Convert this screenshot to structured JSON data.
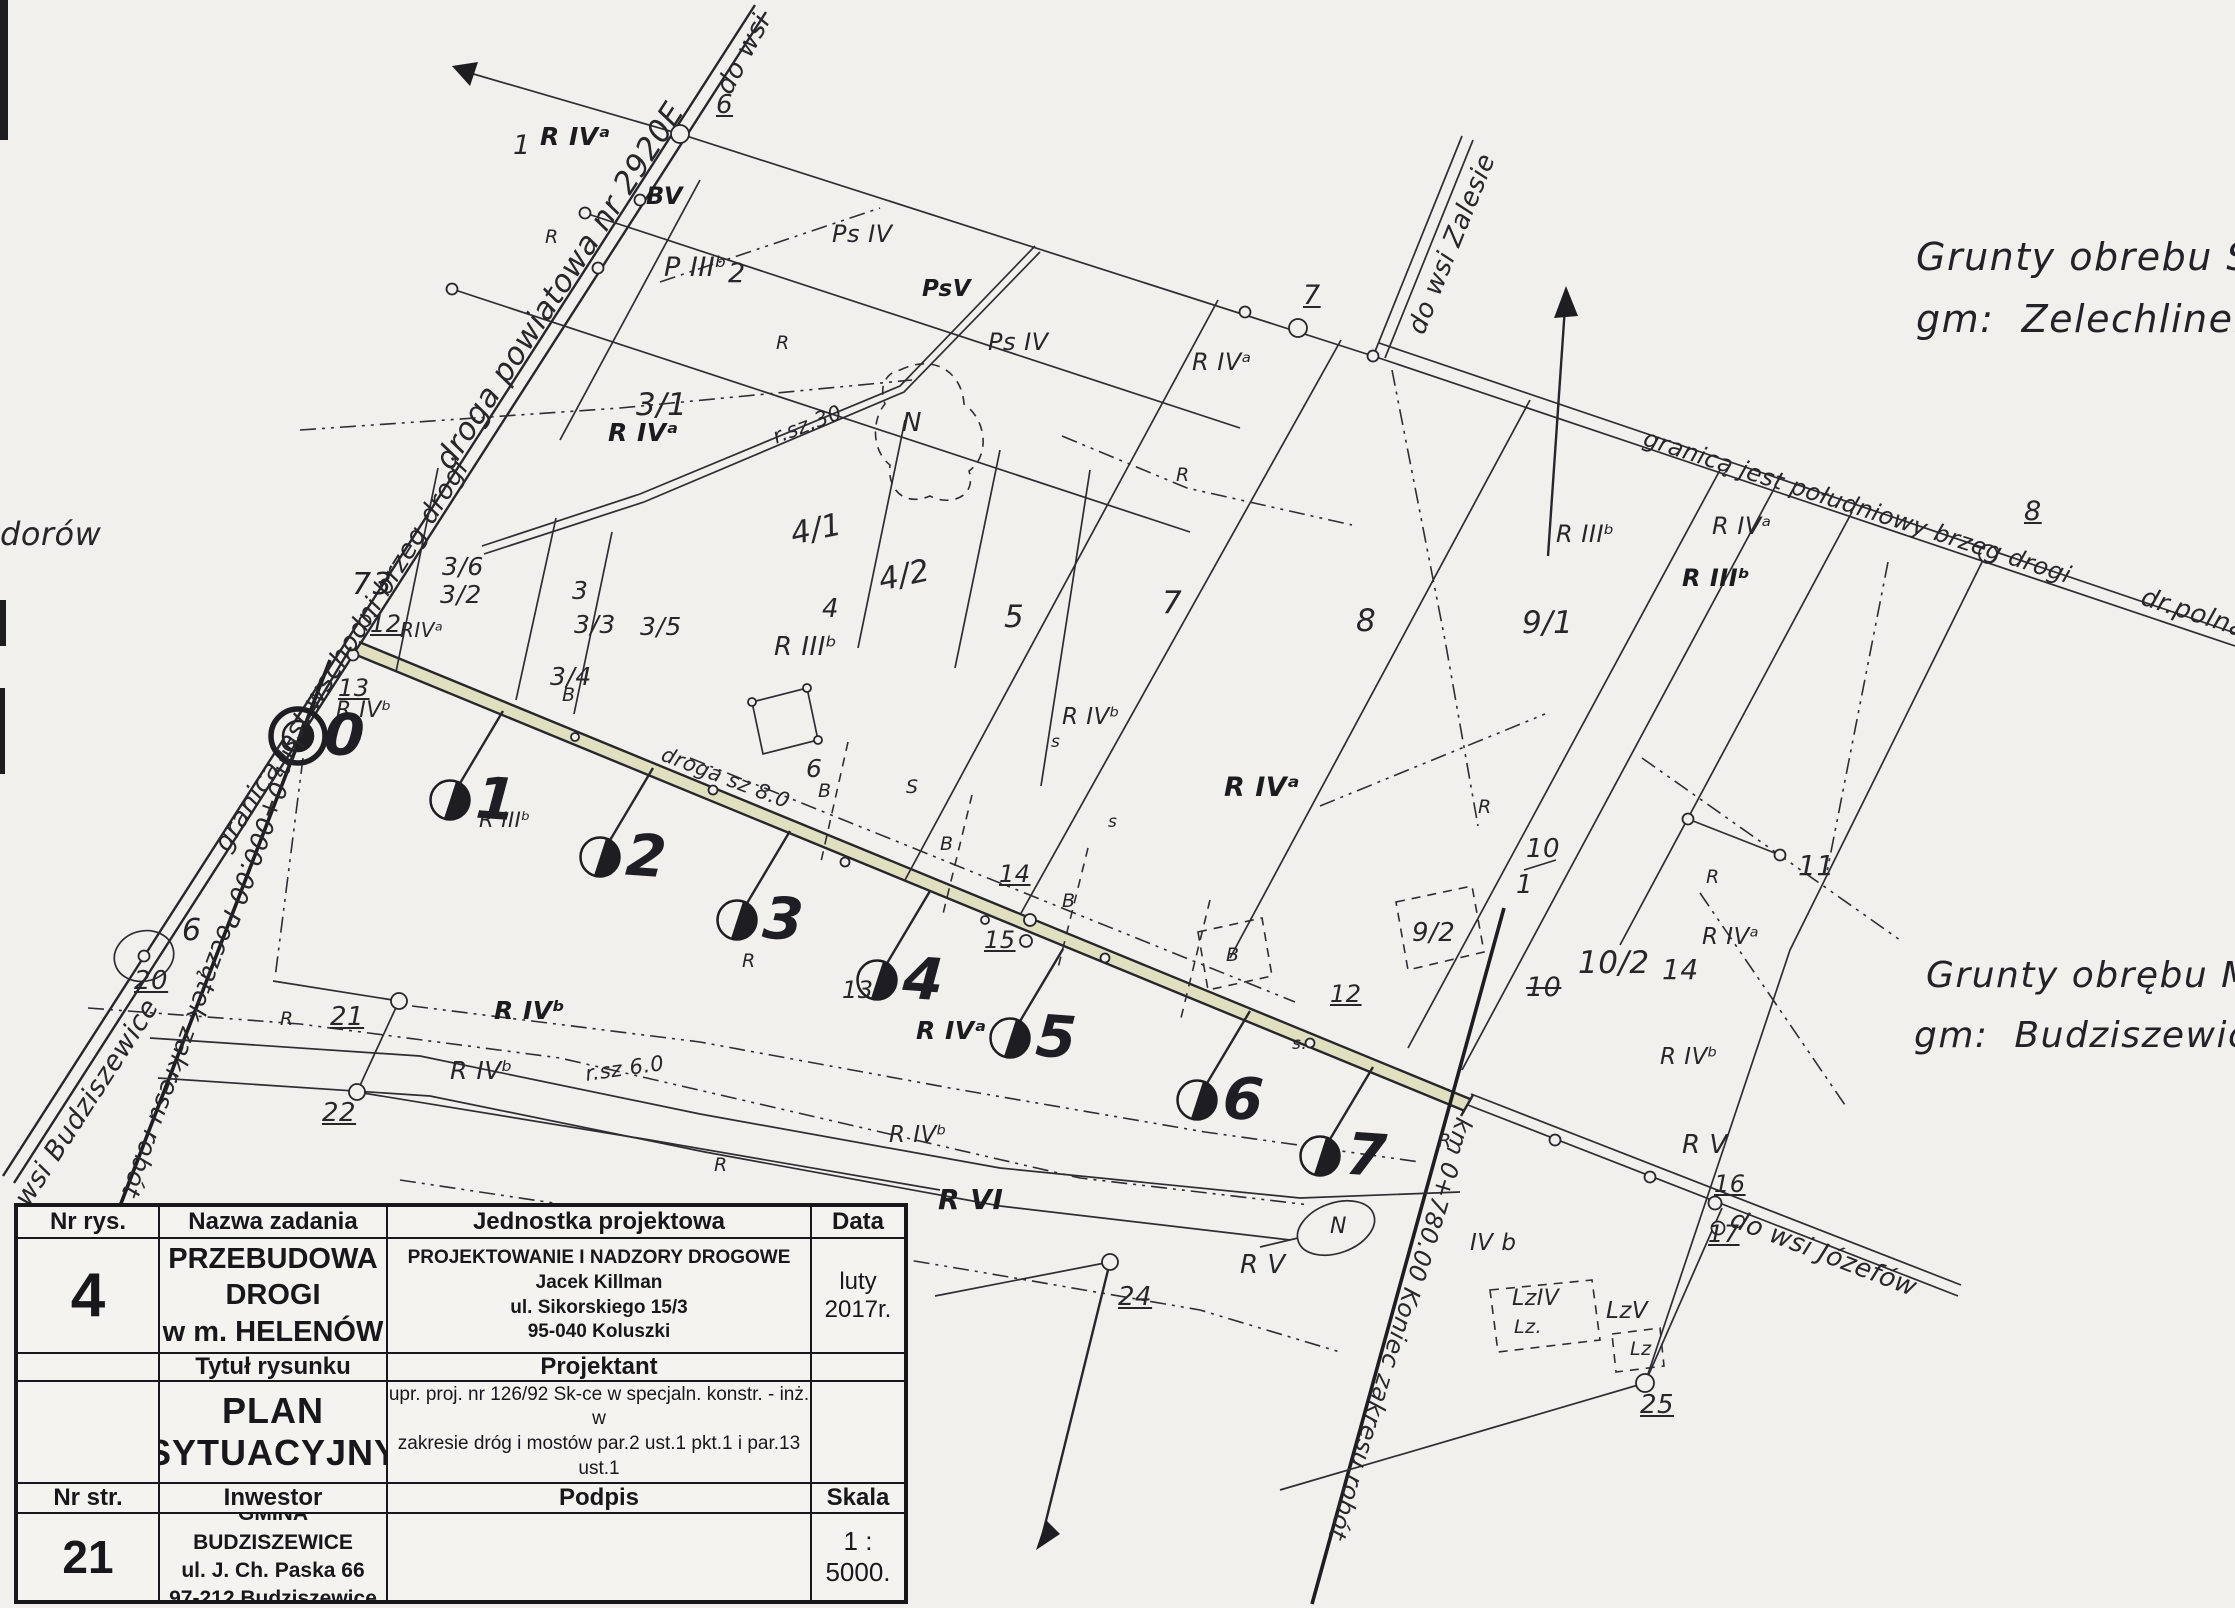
{
  "page": {
    "background": "#f1f0ec",
    "ink": "#26262b",
    "road_highlight": "#e0dfc0"
  },
  "title_block": {
    "headers": {
      "nr_rys": "Nr rys.",
      "nazwa_zadania": "Nazwa zadania",
      "jednostka": "Jednostka projektowa",
      "data": "Data",
      "tytul": "Tytuł rysunku",
      "projektant": "Projektant",
      "nr_str": "Nr str.",
      "inwestor": "Inwestor",
      "podpis": "Podpis",
      "skala": "Skala"
    },
    "values": {
      "drawing_number": "4",
      "task_name_line1": "PRZEBUDOWA DROGI",
      "task_name_line2": "w m. HELENÓW",
      "design_unit": [
        "PROJEKTOWANIE I NADZORY DROGOWE",
        "Jacek Killman",
        "ul. Sikorskiego 15/3",
        "95-040 Koluszki"
      ],
      "date": "luty 2017r.",
      "drawing_title": "PLAN SYTUACYJNY",
      "designer": [
        "mgr inż. Jacek Killman",
        "upr. proj. nr 126/92 Sk-ce w specjaln. konstr. - inż. w",
        "zakresie dróg i mostów par.2 ust.1 pkt.1 i par.13 ust.1",
        "pkt.3 lit.b"
      ],
      "page_number": "21",
      "investor": [
        "GMINA BUDZISZEWICE",
        "ul. J. Ch. Paska 66",
        "97-212 Budziszewice"
      ],
      "scale": "1 : 5000."
    }
  },
  "stations": [
    {
      "label": "0",
      "cx": 298,
      "cy": 736
    },
    {
      "label": "1",
      "cx": 450,
      "cy": 800
    },
    {
      "label": "2",
      "cx": 600,
      "cy": 857
    },
    {
      "label": "3",
      "cx": 737,
      "cy": 920
    },
    {
      "label": "4",
      "cx": 877,
      "cy": 980
    },
    {
      "label": "5",
      "cx": 1010,
      "cy": 1038
    },
    {
      "label": "6",
      "cx": 1197,
      "cy": 1100
    },
    {
      "label": "7",
      "cx": 1320,
      "cy": 1156
    }
  ],
  "map_labels": [
    {
      "t": "do wsi",
      "x": 712,
      "y": 86,
      "r": -62,
      "s": 26
    },
    {
      "t": "6",
      "x": 716,
      "y": 92,
      "s": 26,
      "c": "u"
    },
    {
      "t": "droga powiatowa nr 2920E",
      "x": 430,
      "y": 458,
      "r": -57,
      "s": 31
    },
    {
      "t": "granicą jest wschodni brzeg drogi",
      "x": 210,
      "y": 842,
      "r": -58,
      "s": 26
    },
    {
      "t": "km 0+000.00 Początek zakresu robót",
      "x": 308,
      "y": 742,
      "r": 110,
      "s": 25
    },
    {
      "t": "dorów",
      "x": 0,
      "y": 518,
      "s": 32
    },
    {
      "t": "wsi Budziszewice",
      "x": 10,
      "y": 1196,
      "r": -57,
      "s": 27
    },
    {
      "t": "granicą jest południowy brzeg drogi",
      "x": 1648,
      "y": 426,
      "r": 18,
      "s": 24
    },
    {
      "t": "dr.polna",
      "x": 2146,
      "y": 584,
      "r": 18,
      "s": 26
    },
    {
      "t": "do wsi Zalesie",
      "x": 1404,
      "y": 328,
      "r": -68,
      "s": 26
    },
    {
      "t": "do wsi Józefów",
      "x": 1736,
      "y": 1206,
      "r": 21,
      "s": 26
    },
    {
      "t": "km 0+780.00 Koniec zakresu robót",
      "x": 1476,
      "y": 1122,
      "r": 107,
      "s": 24
    },
    {
      "t": "droga sz 8.0",
      "x": 666,
      "y": 744,
      "r": 21,
      "s": 21
    },
    {
      "t": "r.sz.30",
      "x": 770,
      "y": 428,
      "r": -21,
      "s": 21
    },
    {
      "t": "r.sz 6.0",
      "x": 584,
      "y": 1064,
      "r": -8,
      "s": 21
    },
    {
      "t": "Grunty obrebu Świnio",
      "x": 1916,
      "y": 238,
      "s": 38,
      "c": "hand"
    },
    {
      "t": "gm:  Zelechlinek",
      "x": 1916,
      "y": 300,
      "s": 38,
      "c": "hand"
    },
    {
      "t": "Grunty obrębu Mie",
      "x": 1926,
      "y": 958,
      "s": 36,
      "c": "hand"
    },
    {
      "t": "gm:  Budziszewice",
      "x": 1914,
      "y": 1018,
      "s": 36,
      "c": "hand"
    },
    {
      "t": "7",
      "x": 1303,
      "y": 282,
      "s": 27,
      "c": "u"
    },
    {
      "t": "8",
      "x": 2024,
      "y": 498,
      "s": 27,
      "c": "u"
    },
    {
      "t": "12",
      "x": 370,
      "y": 612,
      "s": 24,
      "c": "u"
    },
    {
      "t": "13",
      "x": 338,
      "y": 676,
      "s": 24,
      "c": "u"
    },
    {
      "t": "73",
      "x": 352,
      "y": 570,
      "s": 30,
      "c": "hand"
    },
    {
      "t": "20",
      "x": 134,
      "y": 968,
      "s": 26,
      "c": "u"
    },
    {
      "t": "21",
      "x": 330,
      "y": 1004,
      "s": 26,
      "c": "u"
    },
    {
      "t": "22",
      "x": 322,
      "y": 1100,
      "s": 26,
      "c": "u"
    },
    {
      "t": "24",
      "x": 1118,
      "y": 1284,
      "s": 26,
      "c": "u"
    },
    {
      "t": "25",
      "x": 1640,
      "y": 1392,
      "s": 26,
      "c": "u"
    },
    {
      "t": "16",
      "x": 1714,
      "y": 1172,
      "s": 24,
      "c": "u"
    },
    {
      "t": "17",
      "x": 1708,
      "y": 1222,
      "s": 24,
      "c": "u"
    },
    {
      "t": "14",
      "x": 999,
      "y": 862,
      "s": 24,
      "c": "u"
    },
    {
      "t": "15",
      "x": 984,
      "y": 928,
      "s": 24,
      "c": "u"
    },
    {
      "t": "6",
      "x": 182,
      "y": 916,
      "s": 30,
      "c": "hand"
    },
    {
      "t": "1",
      "x": 513,
      "y": 132,
      "s": 27
    },
    {
      "t": "P IIIᵇ",
      "x": 664,
      "y": 254,
      "s": 27
    },
    {
      "t": "2",
      "x": 728,
      "y": 260,
      "s": 27
    },
    {
      "t": "3/1",
      "x": 636,
      "y": 390,
      "s": 31
    },
    {
      "t": "3/6",
      "x": 442,
      "y": 554,
      "s": 25
    },
    {
      "t": "3/2",
      "x": 440,
      "y": 582,
      "s": 25
    },
    {
      "t": "3",
      "x": 572,
      "y": 578,
      "s": 25
    },
    {
      "t": "3/3",
      "x": 574,
      "y": 612,
      "s": 25
    },
    {
      "t": "3/5",
      "x": 640,
      "y": 614,
      "s": 25
    },
    {
      "t": "3/4",
      "x": 550,
      "y": 664,
      "s": 25
    },
    {
      "t": "B",
      "x": 562,
      "y": 686,
      "s": 19
    },
    {
      "t": "4/1",
      "x": 788,
      "y": 520,
      "r": -12,
      "s": 31
    },
    {
      "t": "4/2",
      "x": 876,
      "y": 566,
      "r": -12,
      "s": 31
    },
    {
      "t": "4",
      "x": 822,
      "y": 596,
      "s": 26
    },
    {
      "t": "5",
      "x": 1004,
      "y": 602,
      "s": 31
    },
    {
      "t": "7",
      "x": 1162,
      "y": 588,
      "s": 31
    },
    {
      "t": "8",
      "x": 1356,
      "y": 606,
      "s": 31
    },
    {
      "t": "9/1",
      "x": 1522,
      "y": 608,
      "s": 31
    },
    {
      "t": "9/2",
      "x": 1412,
      "y": 920,
      "s": 26
    },
    {
      "t": "10",
      "x": 1526,
      "y": 836,
      "s": 26
    },
    {
      "t": "1",
      "x": 1516,
      "y": 872,
      "s": 26
    },
    {
      "t": "10",
      "x": 1526,
      "y": 974,
      "s": 27,
      "c": "strike"
    },
    {
      "t": "10/2",
      "x": 1578,
      "y": 948,
      "s": 31
    },
    {
      "t": "11",
      "x": 1798,
      "y": 852,
      "s": 28
    },
    {
      "t": "14",
      "x": 1662,
      "y": 956,
      "s": 28
    },
    {
      "t": "12",
      "x": 1330,
      "y": 982,
      "s": 24,
      "c": "u"
    },
    {
      "t": "13",
      "x": 842,
      "y": 978,
      "s": 24
    },
    {
      "t": "R IVᵃ",
      "x": 540,
      "y": 124,
      "s": 25,
      "c": "b"
    },
    {
      "t": "R",
      "x": 545,
      "y": 228,
      "s": 19
    },
    {
      "t": "R",
      "x": 776,
      "y": 334,
      "s": 19
    },
    {
      "t": "BV",
      "x": 646,
      "y": 184,
      "s": 24,
      "c": "b"
    },
    {
      "t": "Ps IV",
      "x": 832,
      "y": 222,
      "s": 24
    },
    {
      "t": "PsV",
      "x": 922,
      "y": 278,
      "s": 23,
      "c": "b"
    },
    {
      "t": "Ps IV",
      "x": 988,
      "y": 330,
      "s": 24
    },
    {
      "t": "R IVᵃ",
      "x": 608,
      "y": 420,
      "s": 25,
      "c": "b"
    },
    {
      "t": "N",
      "x": 902,
      "y": 410,
      "s": 26
    },
    {
      "t": "R IIIᵇ",
      "x": 774,
      "y": 634,
      "s": 26
    },
    {
      "t": "R",
      "x": 1176,
      "y": 466,
      "s": 19
    },
    {
      "t": "R IVᵃ",
      "x": 1192,
      "y": 350,
      "s": 24
    },
    {
      "t": "R IIIᵇ",
      "x": 1556,
      "y": 522,
      "s": 24
    },
    {
      "t": "R IVᵃ",
      "x": 1712,
      "y": 514,
      "s": 24
    },
    {
      "t": "R IIIᵇ",
      "x": 1682,
      "y": 566,
      "s": 24,
      "c": "b"
    },
    {
      "t": "R",
      "x": 1478,
      "y": 798,
      "s": 19
    },
    {
      "t": "R IVᵃ",
      "x": 1224,
      "y": 774,
      "s": 27,
      "c": "b"
    },
    {
      "t": "R IVᵇ",
      "x": 1062,
      "y": 706,
      "s": 23
    },
    {
      "t": "s",
      "x": 1051,
      "y": 734,
      "s": 17
    },
    {
      "t": "s",
      "x": 1108,
      "y": 814,
      "s": 17
    },
    {
      "t": "S",
      "x": 906,
      "y": 778,
      "s": 19
    },
    {
      "t": "B",
      "x": 818,
      "y": 782,
      "s": 19
    },
    {
      "t": "B",
      "x": 940,
      "y": 835,
      "s": 19
    },
    {
      "t": "B",
      "x": 1062,
      "y": 892,
      "s": 19
    },
    {
      "t": "B",
      "x": 1226,
      "y": 946,
      "s": 19
    },
    {
      "t": "s.",
      "x": 1292,
      "y": 1036,
      "s": 17
    },
    {
      "t": "6",
      "x": 806,
      "y": 756,
      "s": 25
    },
    {
      "t": "R IIIᵇ",
      "x": 479,
      "y": 810,
      "s": 21
    },
    {
      "t": "R",
      "x": 742,
      "y": 952,
      "s": 19
    },
    {
      "t": "R IVᵃ",
      "x": 916,
      "y": 1018,
      "s": 25,
      "c": "b"
    },
    {
      "t": "R IVᵇ",
      "x": 494,
      "y": 998,
      "s": 25,
      "c": "b"
    },
    {
      "t": "R IVᵇ",
      "x": 450,
      "y": 1058,
      "s": 25
    },
    {
      "t": "R",
      "x": 280,
      "y": 1010,
      "s": 19
    },
    {
      "t": "R",
      "x": 714,
      "y": 1156,
      "s": 19
    },
    {
      "t": "R IVᵇ",
      "x": 889,
      "y": 1124,
      "s": 23
    },
    {
      "t": "R VI",
      "x": 938,
      "y": 1186,
      "s": 28,
      "c": "b"
    },
    {
      "t": "R V",
      "x": 848,
      "y": 1298,
      "s": 26
    },
    {
      "t": "R V",
      "x": 1240,
      "y": 1252,
      "s": 26
    },
    {
      "t": "R",
      "x": 1438,
      "y": 1132,
      "s": 19
    },
    {
      "t": "IV b",
      "x": 1470,
      "y": 1232,
      "s": 23
    },
    {
      "t": "R V",
      "x": 1682,
      "y": 1132,
      "s": 26
    },
    {
      "t": "R IVᵇ",
      "x": 1660,
      "y": 1046,
      "s": 23
    },
    {
      "t": "R IVᵃ",
      "x": 1702,
      "y": 926,
      "s": 23
    },
    {
      "t": "R",
      "x": 1706,
      "y": 868,
      "s": 19
    },
    {
      "t": "LzIV",
      "x": 1512,
      "y": 1288,
      "s": 22
    },
    {
      "t": "Lz.",
      "x": 1514,
      "y": 1318,
      "s": 19
    },
    {
      "t": "LzV",
      "x": 1606,
      "y": 1300,
      "s": 23
    },
    {
      "t": "Lz",
      "x": 1630,
      "y": 1340,
      "s": 19
    },
    {
      "t": "N",
      "x": 1330,
      "y": 1216,
      "s": 22
    },
    {
      "t": "R IVᵇ",
      "x": 336,
      "y": 700,
      "s": 22
    },
    {
      "t": "RIVᵃ",
      "x": 400,
      "y": 620,
      "s": 20
    }
  ]
}
